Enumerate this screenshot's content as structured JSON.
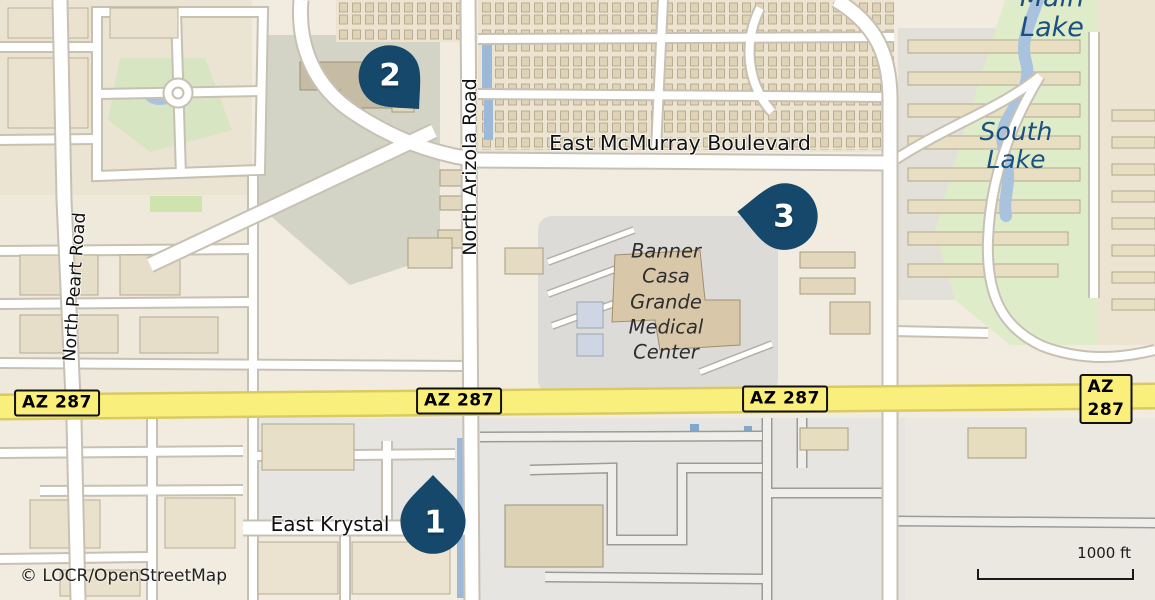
{
  "map": {
    "attribution": "© LOCR/OpenStreetMap",
    "scale_bar": {
      "label": "1000 ft"
    },
    "markers": [
      {
        "number": "1"
      },
      {
        "number": "2"
      },
      {
        "number": "3"
      }
    ],
    "route_shields": [
      {
        "label": "AZ 287"
      },
      {
        "label": "AZ 287"
      },
      {
        "label": "AZ 287"
      },
      {
        "label": "AZ 287"
      }
    ],
    "road_labels": {
      "peart": "North Peart Road",
      "arizola": "North Arizola Road",
      "mcmurray": "East McMurray Boulevard",
      "krystal": "East Krystal"
    },
    "place_labels": {
      "main_lake": "Main Lake",
      "south_lake_lines": [
        "South",
        "Lake"
      ],
      "medical_center_lines": [
        "Banner",
        "Casa",
        "Grande",
        "Medical",
        "Center"
      ]
    },
    "colors": {
      "marker": "#15486b",
      "highway_fill": "#f8ef7d",
      "highway_casing": "#d9cb60",
      "water": "#a9c3de",
      "park_green": "#dfecca",
      "water_label": "#1d4f7f",
      "land_base": "#f1ecdf"
    }
  }
}
